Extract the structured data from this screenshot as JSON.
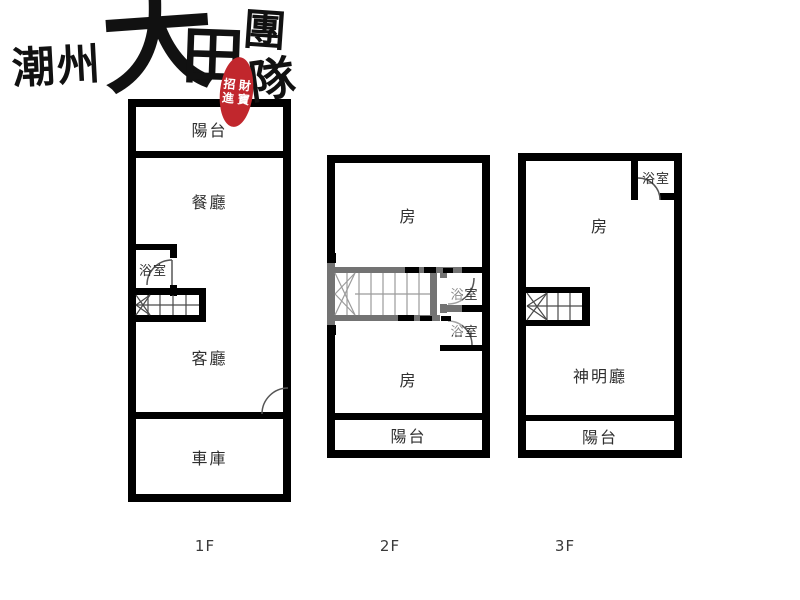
{
  "logo": {
    "region": "潮州",
    "brand_first": "大",
    "brand_second": "田",
    "team_first": "團",
    "team_second": "隊",
    "seal_chars": [
      "招",
      "財",
      "進",
      "寶"
    ],
    "seal_color": "#c1272d",
    "ink_color": "#111111"
  },
  "colors": {
    "wall": "#000000",
    "label_text": "#2f2f2f"
  },
  "floors": [
    {
      "label": "1F",
      "rooms": {
        "balcony": "陽台",
        "dining": "餐廳",
        "bath": "浴室",
        "living": "客廳",
        "garage": "車庫"
      }
    },
    {
      "label": "2F",
      "rooms": {
        "room_top": "房",
        "bath_upper": "浴室",
        "bath_lower": "浴室",
        "room_bottom": "房",
        "balcony": "陽台"
      }
    },
    {
      "label": "3F",
      "rooms": {
        "bath": "浴室",
        "room": "房",
        "shrine": "神明廳",
        "balcony": "陽台"
      }
    }
  ]
}
